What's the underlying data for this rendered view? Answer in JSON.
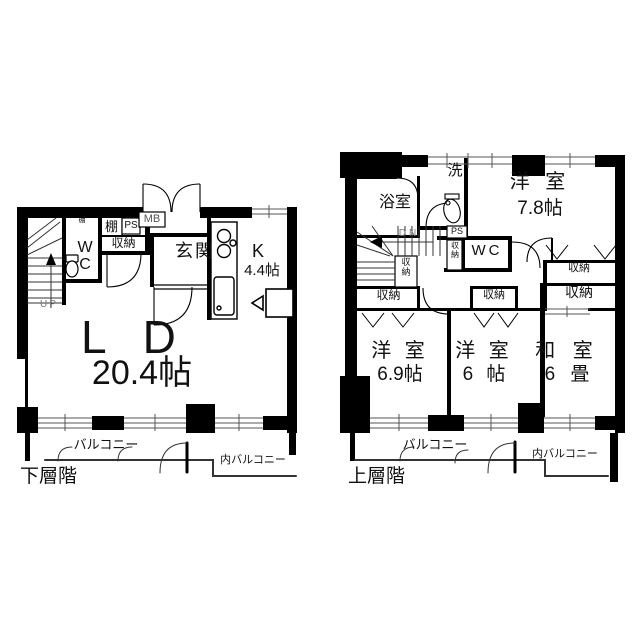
{
  "floorplan": {
    "lower": {
      "caption": "下層階",
      "ld_name": "L D",
      "ld_size": "20.4帖",
      "kitchen_name": "K",
      "kitchen_size": "4.4帖",
      "genkan": "玄関",
      "wc": "WC",
      "shelf_small": "棚",
      "shelf": "棚",
      "ps": "PS",
      "storage": "収納",
      "mb": "MB",
      "up": "UP",
      "balcony": "バルコニー",
      "inner_balcony": "内バルコニー"
    },
    "upper": {
      "caption": "上層階",
      "bath": "浴室",
      "laundry": "洗",
      "wc": "WC",
      "dn": "DN",
      "ps": "PS",
      "storage": "収納",
      "western_78_name": "洋 室",
      "western_78_size": "7.8帖",
      "western_69_name": "洋 室",
      "western_69_size": "6.9帖",
      "western_6_name": "洋 室",
      "western_6_size": "6 帖",
      "japanese_name": "和 室",
      "japanese_size": "6 畳",
      "balcony": "バルコニー",
      "inner_balcony": "内バルコニー"
    }
  }
}
